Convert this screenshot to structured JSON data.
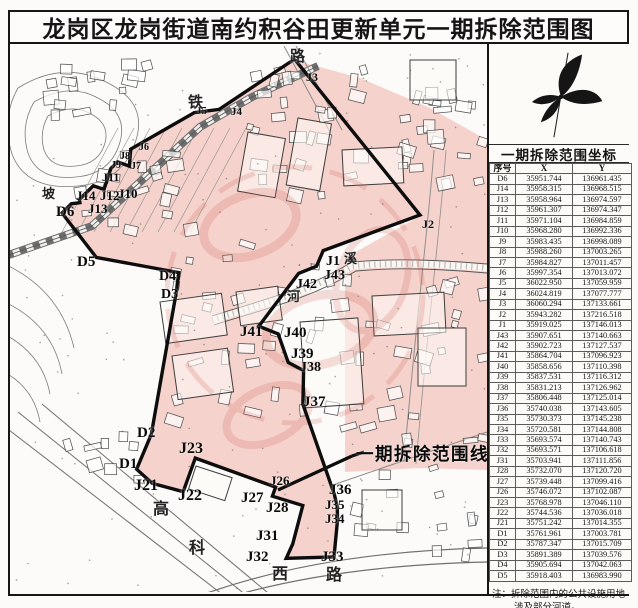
{
  "page": {
    "title": "龙岗区龙岗街道南约积谷田更新单元一期拆除范围图"
  },
  "side_panel": {
    "compass_icon": "north-compass",
    "table": {
      "title": "一期拆除范围坐标",
      "columns": [
        "序号",
        "X",
        "Y"
      ],
      "rows": [
        [
          "D6",
          "35951.744",
          "136961.435"
        ],
        [
          "J14",
          "35958.315",
          "136968.515"
        ],
        [
          "J13",
          "35958.964",
          "136974.597"
        ],
        [
          "J12",
          "35961.307",
          "136974.347"
        ],
        [
          "J11",
          "35971.104",
          "136984.859"
        ],
        [
          "J10",
          "35968.280",
          "136992.336"
        ],
        [
          "J9",
          "35983.435",
          "136998.089"
        ],
        [
          "J8",
          "35988.260",
          "137003.265"
        ],
        [
          "J7",
          "35984.827",
          "137011.457"
        ],
        [
          "J6",
          "35997.354",
          "137013.072"
        ],
        [
          "J5",
          "36022.950",
          "137059.959"
        ],
        [
          "J4",
          "36024.819",
          "137077.777"
        ],
        [
          "J3",
          "36060.294",
          "137133.661"
        ],
        [
          "J2",
          "35943.282",
          "137216.518"
        ],
        [
          "J1",
          "35919.025",
          "137146.013"
        ],
        [
          "J43",
          "35907.651",
          "137140.663"
        ],
        [
          "J42",
          "35902.723",
          "137127.537"
        ],
        [
          "J41",
          "35864.704",
          "137096.923"
        ],
        [
          "J40",
          "35858.656",
          "137110.398"
        ],
        [
          "J39",
          "35837.531",
          "137116.312"
        ],
        [
          "J38",
          "35831.213",
          "137126.962"
        ],
        [
          "J37",
          "35806.448",
          "137125.014"
        ],
        [
          "J36",
          "35740.038",
          "137143.605"
        ],
        [
          "J35",
          "35730.373",
          "137145.238"
        ],
        [
          "J34",
          "35720.581",
          "137144.808"
        ],
        [
          "J33",
          "35693.574",
          "137140.743"
        ],
        [
          "J32",
          "35693.571",
          "137106.618"
        ],
        [
          "J31",
          "35703.941",
          "137111.856"
        ],
        [
          "J28",
          "35732.070",
          "137120.720"
        ],
        [
          "J27",
          "35739.448",
          "137099.416"
        ],
        [
          "J26",
          "35746.072",
          "137102.087"
        ],
        [
          "J23",
          "35768.978",
          "137046.110"
        ],
        [
          "J22",
          "35744.536",
          "137036.018"
        ],
        [
          "J21",
          "35751.242",
          "137014.355"
        ],
        [
          "D1",
          "35761.961",
          "137003.781"
        ],
        [
          "D2",
          "35787.347",
          "137015.709"
        ],
        [
          "D3",
          "35891.389",
          "137039.576"
        ],
        [
          "D4",
          "35905.694",
          "137042.063"
        ],
        [
          "D5",
          "35918.403",
          "136983.990"
        ]
      ]
    },
    "note": {
      "label": "注：",
      "line1": "拆除范围内的公共设施用地",
      "line2": "涉及部分河道。"
    }
  },
  "map": {
    "legend_label": "一期拆除范围线",
    "vertex_labels": [
      {
        "t": "D6",
        "x": 56,
        "y": 205,
        "s": 15
      },
      {
        "t": "J14",
        "x": 76,
        "y": 189,
        "s": 13
      },
      {
        "t": "J13",
        "x": 88,
        "y": 202,
        "s": 13
      },
      {
        "t": "J12",
        "x": 100,
        "y": 189,
        "s": 13
      },
      {
        "t": "J11",
        "x": 102,
        "y": 171,
        "s": 12
      },
      {
        "t": "J10",
        "x": 118,
        "y": 187,
        "s": 13
      },
      {
        "t": "J9",
        "x": 111,
        "y": 161,
        "s": 10
      },
      {
        "t": "J8",
        "x": 120,
        "y": 152,
        "s": 10
      },
      {
        "t": "J7",
        "x": 131,
        "y": 162,
        "s": 10
      },
      {
        "t": "J6",
        "x": 139,
        "y": 143,
        "s": 10
      },
      {
        "t": "J5",
        "x": 196,
        "y": 106,
        "s": 11
      },
      {
        "t": "J4",
        "x": 231,
        "y": 107,
        "s": 11
      },
      {
        "t": "J3",
        "x": 306,
        "y": 71,
        "s": 12
      },
      {
        "t": "J2",
        "x": 422,
        "y": 218,
        "s": 12
      },
      {
        "t": "J1",
        "x": 326,
        "y": 255,
        "s": 14
      },
      {
        "t": "J43",
        "x": 324,
        "y": 269,
        "s": 14
      },
      {
        "t": "J42",
        "x": 296,
        "y": 278,
        "s": 14
      },
      {
        "t": "J41",
        "x": 240,
        "y": 325,
        "s": 15
      },
      {
        "t": "J40",
        "x": 284,
        "y": 326,
        "s": 15
      },
      {
        "t": "J39",
        "x": 291,
        "y": 347,
        "s": 15
      },
      {
        "t": "J38",
        "x": 300,
        "y": 361,
        "s": 14
      },
      {
        "t": "J37",
        "x": 303,
        "y": 395,
        "s": 15
      },
      {
        "t": "J36",
        "x": 329,
        "y": 483,
        "s": 15
      },
      {
        "t": "J35",
        "x": 325,
        "y": 498,
        "s": 13
      },
      {
        "t": "J34",
        "x": 325,
        "y": 512,
        "s": 13
      },
      {
        "t": "J33",
        "x": 321,
        "y": 550,
        "s": 15
      },
      {
        "t": "J32",
        "x": 246,
        "y": 550,
        "s": 15
      },
      {
        "t": "J31",
        "x": 256,
        "y": 529,
        "s": 15
      },
      {
        "t": "J28",
        "x": 266,
        "y": 501,
        "s": 15
      },
      {
        "t": "J27",
        "x": 241,
        "y": 491,
        "s": 15
      },
      {
        "t": "J26",
        "x": 270,
        "y": 474,
        "s": 13
      },
      {
        "t": "J23",
        "x": 179,
        "y": 441,
        "s": 16
      },
      {
        "t": "J22",
        "x": 178,
        "y": 488,
        "s": 16
      },
      {
        "t": "J21",
        "x": 134,
        "y": 478,
        "s": 16
      },
      {
        "t": "D1",
        "x": 119,
        "y": 457,
        "s": 15
      },
      {
        "t": "D2",
        "x": 137,
        "y": 426,
        "s": 15
      },
      {
        "t": "D3",
        "x": 161,
        "y": 288,
        "s": 14
      },
      {
        "t": "D4",
        "x": 159,
        "y": 270,
        "s": 14
      },
      {
        "t": "D5",
        "x": 77,
        "y": 255,
        "s": 15
      }
    ],
    "place_labels": [
      {
        "t": "铁",
        "x": 188,
        "y": 96,
        "s": 15
      },
      {
        "t": "路",
        "x": 290,
        "y": 50,
        "s": 15
      },
      {
        "t": "坡",
        "x": 42,
        "y": 187,
        "s": 13
      },
      {
        "t": "河",
        "x": 287,
        "y": 290,
        "s": 13
      },
      {
        "t": "溪",
        "x": 344,
        "y": 252,
        "s": 13
      },
      {
        "t": "高",
        "x": 153,
        "y": 502,
        "s": 16
      },
      {
        "t": "科",
        "x": 189,
        "y": 541,
        "s": 16
      },
      {
        "t": "西",
        "x": 272,
        "y": 567,
        "s": 16
      },
      {
        "t": "路",
        "x": 326,
        "y": 568,
        "s": 16
      }
    ]
  },
  "colors": {
    "demolition_fill": "#f5d2cc",
    "boundary_line": "#0d0d0d",
    "watermark_red": "#cf5f52"
  }
}
